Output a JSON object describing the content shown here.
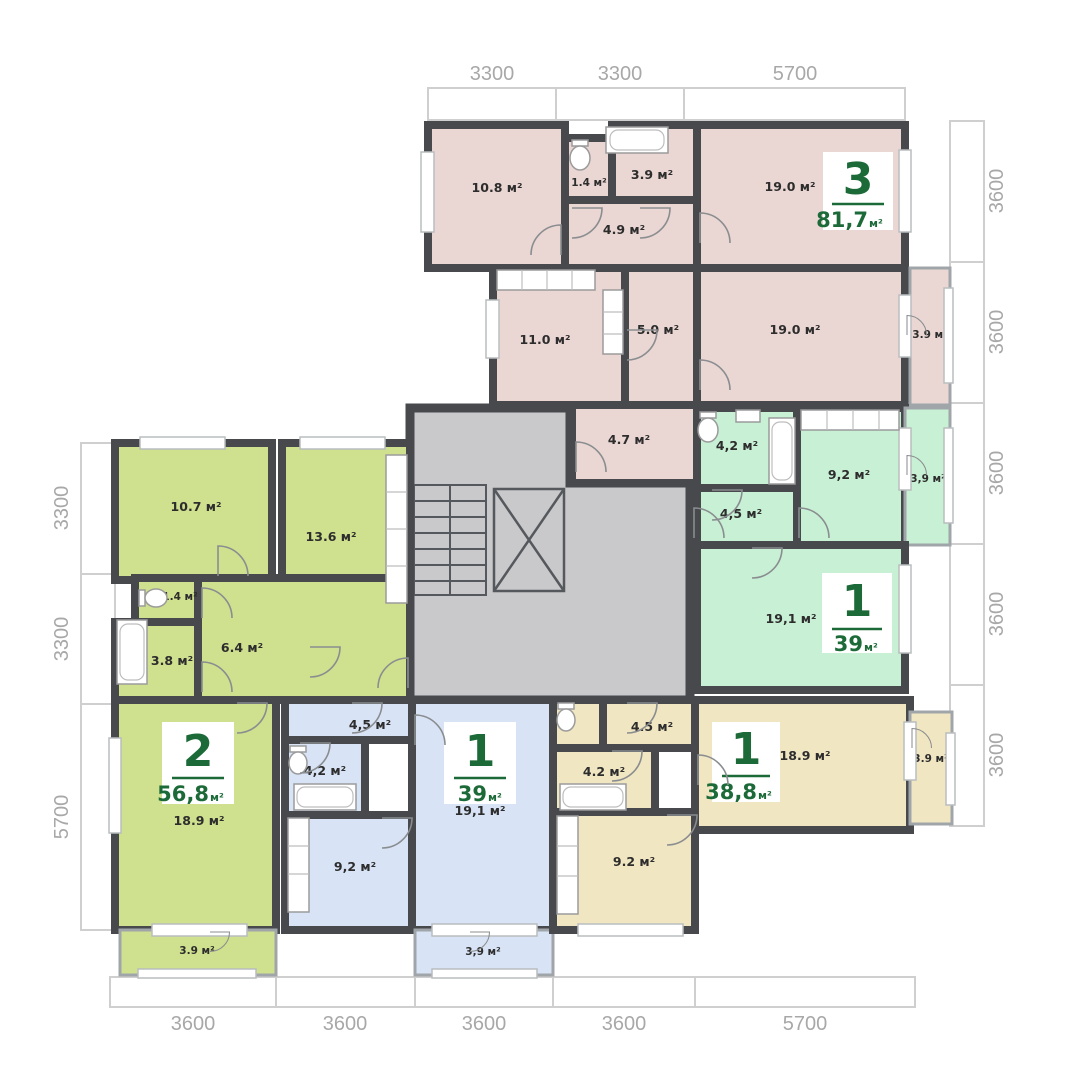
{
  "plan_type": "floor-plan",
  "colors": {
    "wall": "#47494d",
    "stair_core": "#c9c9cb",
    "accent_green": "#1b6a38",
    "dimension_text": "#a8a8a8",
    "background": "#ffffff"
  },
  "dimensions": {
    "top": [
      "3300",
      "3300",
      "5700"
    ],
    "right": [
      "3600",
      "3600",
      "3600",
      "3600",
      "3600"
    ],
    "left": [
      "3300",
      "3300",
      "5700"
    ],
    "bottom": [
      "3600",
      "3600",
      "3600",
      "3600",
      "5700"
    ]
  },
  "apartments": [
    {
      "id": "apt-3-rooms-pink",
      "color": "#ead6d2",
      "number": "3",
      "area": "81,7",
      "unit": "м²",
      "rooms": [
        "10.8 м²",
        "1.4 м²",
        "3.9 м²",
        "4.9 м²",
        "19.0 м²",
        "11.0 м²",
        "5.0 м²",
        "19.0 м²",
        "3.9 м²",
        "4.7 м²"
      ]
    },
    {
      "id": "apt-1-room-mint",
      "color": "#c8f0d5",
      "number": "1",
      "area": "39",
      "unit": "м²",
      "rooms": [
        "4,2 м²",
        "4,5 м²",
        "9,2 м²",
        "3,9 м²",
        "19,1 м²"
      ]
    },
    {
      "id": "apt-2-rooms-lime",
      "color": "#cfe08e",
      "number": "2",
      "area": "56,8",
      "unit": "м²",
      "rooms": [
        "10.7 м²",
        "13.6 м²",
        "1.4 м²",
        "3.8 м²",
        "6.4 м²",
        "18.9 м²",
        "3.9 м²"
      ]
    },
    {
      "id": "apt-1-room-blue",
      "color": "#d8e3f5",
      "number": "1",
      "area": "39",
      "unit": "м²",
      "rooms": [
        "4,5 м²",
        "4,2 м²",
        "9,2 м²",
        "19,1 м²",
        "3,9 м²"
      ]
    },
    {
      "id": "apt-1-room-beige",
      "color": "#f1e6c2",
      "number": "1",
      "area": "38,8",
      "unit": "м²",
      "rooms": [
        "4.5 м²",
        "4.2 м²",
        "9.2 м²",
        "18.9 м²",
        "3.9 м²"
      ]
    }
  ]
}
